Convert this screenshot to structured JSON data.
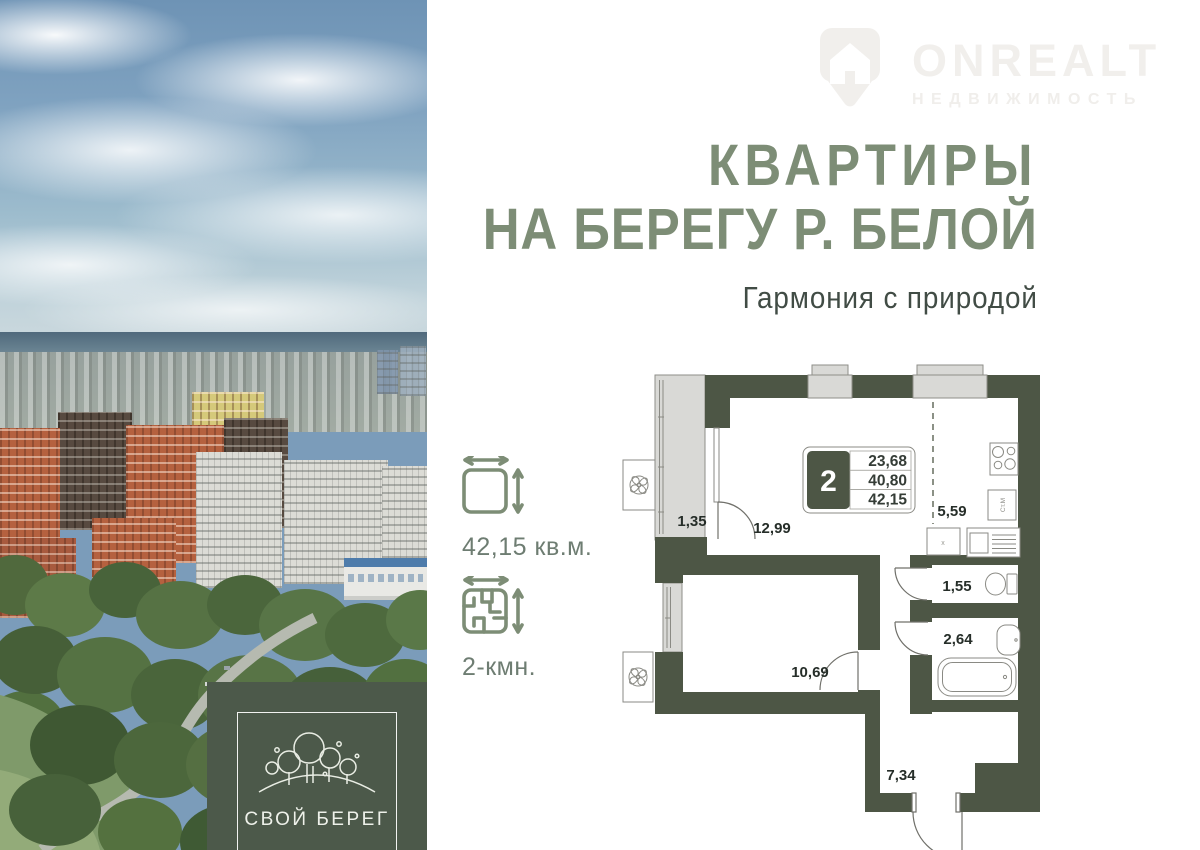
{
  "watermark": {
    "brand": "ONREALT",
    "tagline": "НЕДВИЖИМОСТЬ"
  },
  "headline": {
    "line1": "КВАРТИРЫ",
    "line2": "НА БЕРЕГУ Р. БЕЛОЙ",
    "subtitle": "Гармония с природой"
  },
  "specs": {
    "area": "42,15 кв.м.",
    "rooms": "2-кмн."
  },
  "developer": {
    "name": "СВОЙ БЕРЕГ"
  },
  "floor_plan": {
    "rooms_badge": "2",
    "areas": [
      "23,68",
      "40,80",
      "42,15"
    ],
    "labels": {
      "balcony": "1,35",
      "living": "12,99",
      "kitchen": "5,59",
      "wc": "1,55",
      "bathroom": "2,64",
      "bedroom": "10,69",
      "hallway": "7,34"
    },
    "washer_label": "Ст.М",
    "cabinet_label": "x"
  },
  "colors": {
    "accent_green": "#7d8d76",
    "wall_olive": "#4d5645",
    "subtitle_gray": "#414c45",
    "spec_label_gray": "#6e7d72",
    "logo_background": "#4c594a",
    "watermark_gray": "#f1efec"
  }
}
